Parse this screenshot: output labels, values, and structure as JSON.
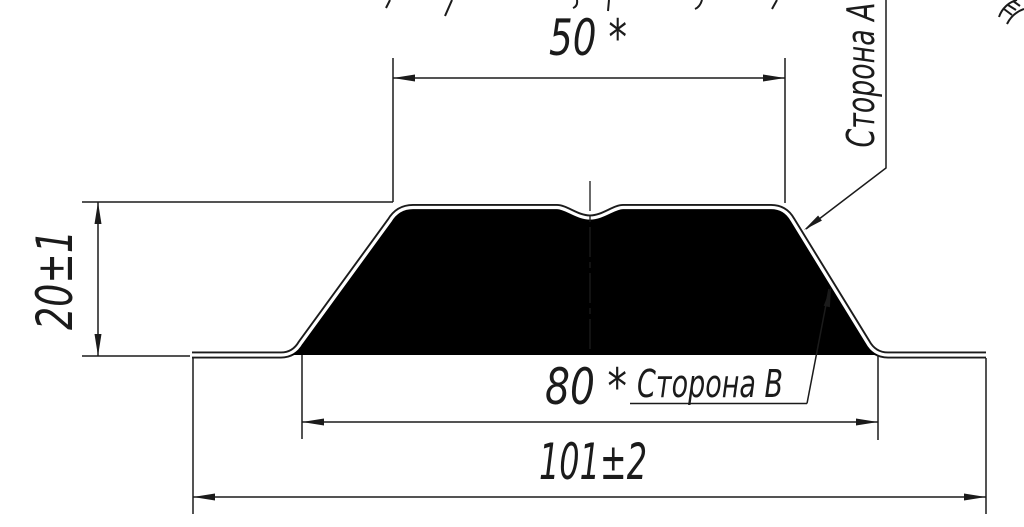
{
  "drawing": {
    "background": "#ffffff",
    "line_color": "#1b1b1b",
    "dimensions": {
      "top_width": {
        "label": "50 *"
      },
      "height": {
        "label": "20±1"
      },
      "base_width": {
        "label": "80 *"
      },
      "overall_width": {
        "label": "101±2"
      }
    },
    "callouts": {
      "side_a": {
        "label": "Сторона А"
      },
      "side_b": {
        "label": "Сторона В"
      }
    }
  }
}
